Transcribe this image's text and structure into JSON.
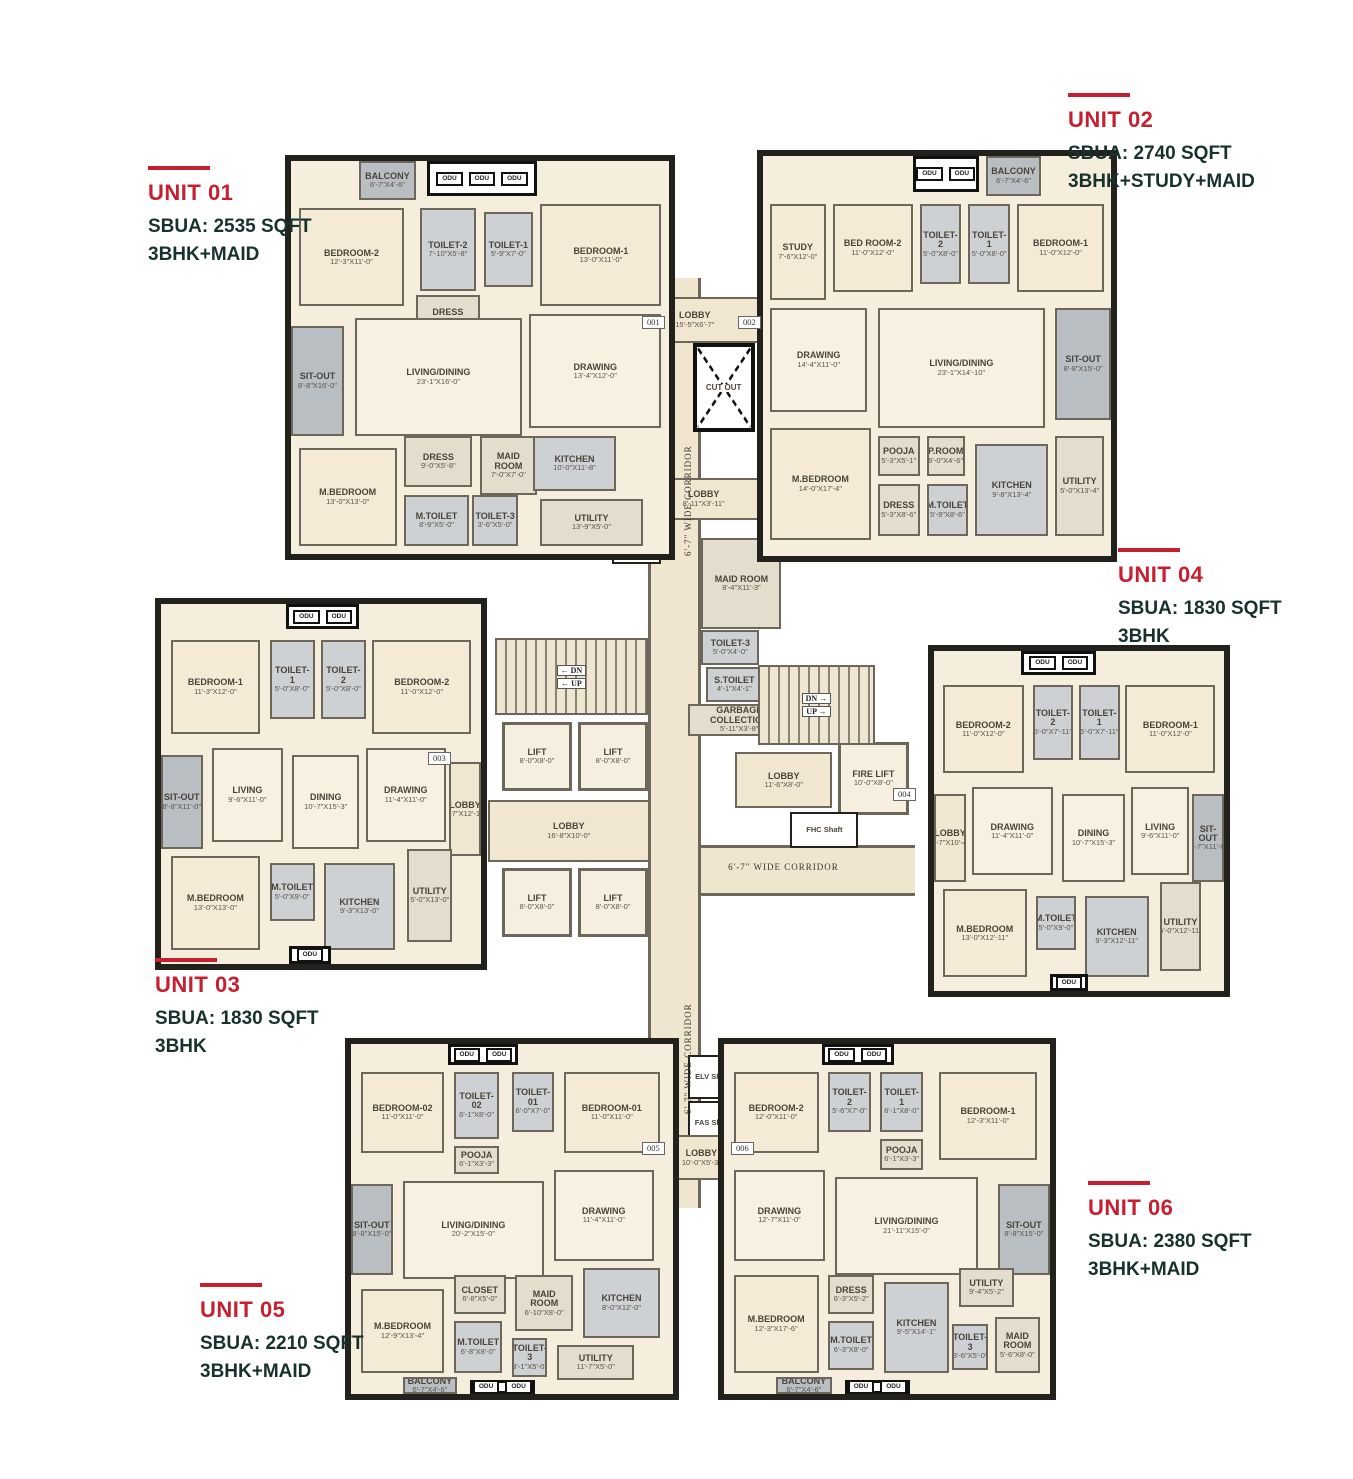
{
  "palette": {
    "accent_red": "#c61f30",
    "text_dark": "#17312c",
    "wall": "#23211c",
    "floor": "#f6eedd",
    "wet": "#cdd1d3",
    "outdoor": "#b9bec3"
  },
  "odu_label": "ODU",
  "units": [
    {
      "id": "unit-01",
      "label": "UNIT 01",
      "sbua": "SBUA: 2535 SQFT",
      "config": "3BHK+MAID",
      "rooms": [
        {
          "name": "BALCONY",
          "dim": "6'-7\"X4'-6\"",
          "kind": "outdoor"
        },
        {
          "name": "BEDROOM-2",
          "dim": "12'-3\"X11'-0\"",
          "kind": "bed"
        },
        {
          "name": "TOILET-2",
          "dim": "7'-10\"X5'-8\"",
          "kind": "wet"
        },
        {
          "name": "TOILET-1",
          "dim": "5'-9\"X7'-0\"",
          "kind": "wet"
        },
        {
          "name": "BEDROOM-1",
          "dim": "13'-0\"X11'-0\"",
          "kind": "bed"
        },
        {
          "name": "DRESS",
          "dim": "8'-0\"X5'-8\"",
          "kind": "service"
        },
        {
          "name": "SIT-OUT",
          "dim": "8'-8\"X16'-0\"",
          "kind": "outdoor"
        },
        {
          "name": "LIVING/DINING",
          "dim": "23'-1\"X16'-0\"",
          "kind": "living"
        },
        {
          "name": "DRAWING",
          "dim": "13'-4\"X12'-0\"",
          "kind": "living"
        },
        {
          "name": "M.BEDROOM",
          "dim": "13'-0\"X13'-0\"",
          "kind": "bed"
        },
        {
          "name": "DRESS",
          "dim": "9'-0\"X5'-8\"",
          "kind": "service"
        },
        {
          "name": "MAID ROOM",
          "dim": "7'-0\"X7'-0\"",
          "kind": "service"
        },
        {
          "name": "M.TOILET",
          "dim": "8'-9\"X5'-0\"",
          "kind": "wet"
        },
        {
          "name": "TOILET-3",
          "dim": "3'-6\"X5'-0\"",
          "kind": "wet"
        },
        {
          "name": "KITCHEN",
          "dim": "10'-0\"X11'-8\"",
          "kind": "wet"
        },
        {
          "name": "UTILITY",
          "dim": "13'-9\"X5'-0\"",
          "kind": "service"
        }
      ]
    },
    {
      "id": "unit-02",
      "label": "UNIT 02",
      "sbua": "SBUA: 2740 SQFT",
      "config": "3BHK+STUDY+MAID",
      "rooms": [
        {
          "name": "BALCONY",
          "dim": "6'-7\"X4'-6\"",
          "kind": "outdoor"
        },
        {
          "name": "STUDY",
          "dim": "7'-6\"X12'-0\"",
          "kind": "bed"
        },
        {
          "name": "BED ROOM-2",
          "dim": "11'-0\"X12'-0\"",
          "kind": "bed"
        },
        {
          "name": "TOILET-2",
          "dim": "5'-0\"X8'-0\"",
          "kind": "wet"
        },
        {
          "name": "TOILET-1",
          "dim": "5'-0\"X8'-0\"",
          "kind": "wet"
        },
        {
          "name": "BEDROOM-1",
          "dim": "11'-0\"X12'-0\"",
          "kind": "bed"
        },
        {
          "name": "DRAWING",
          "dim": "14'-4\"X11'-0\"",
          "kind": "living"
        },
        {
          "name": "LIVING/DINING",
          "dim": "23'-1\"X14'-10\"",
          "kind": "living"
        },
        {
          "name": "SIT-OUT",
          "dim": "8'-8\"X15'-0\"",
          "kind": "outdoor"
        },
        {
          "name": "M.BEDROOM",
          "dim": "14'-0\"X17'-4\"",
          "kind": "bed"
        },
        {
          "name": "POOJA",
          "dim": "5'-3\"X5'-1\"",
          "kind": "service"
        },
        {
          "name": "P.ROOM",
          "dim": "6'-0\"X4'-6\"",
          "kind": "service"
        },
        {
          "name": "DRESS",
          "dim": "5'-3\"X8'-6\"",
          "kind": "service"
        },
        {
          "name": "M.TOILET",
          "dim": "5'-9\"X8'-6\"",
          "kind": "wet"
        },
        {
          "name": "KITCHEN",
          "dim": "9'-8\"X13'-4\"",
          "kind": "wet"
        },
        {
          "name": "UTILITY",
          "dim": "5'-0\"X13'-4\"",
          "kind": "service"
        }
      ]
    },
    {
      "id": "unit-03",
      "label": "UNIT 03",
      "sbua": "SBUA: 1830 SQFT",
      "config": "3BHK",
      "rooms": [
        {
          "name": "BEDROOM-1",
          "dim": "11'-3\"X12'-0\"",
          "kind": "bed"
        },
        {
          "name": "TOILET-1",
          "dim": "5'-0\"X8'-0\"",
          "kind": "wet"
        },
        {
          "name": "TOILET-2",
          "dim": "5'-0\"X8'-0\"",
          "kind": "wet"
        },
        {
          "name": "BEDROOM-2",
          "dim": "11'-0\"X12'-0\"",
          "kind": "bed"
        },
        {
          "name": "SIT-OUT",
          "dim": "8'-8\"X11'-0\"",
          "kind": "outdoor"
        },
        {
          "name": "LIVING",
          "dim": "9'-6\"X11'-0\"",
          "kind": "living"
        },
        {
          "name": "DINING",
          "dim": "10'-7\"X15'-3\"",
          "kind": "living"
        },
        {
          "name": "DRAWING",
          "dim": "11'-4\"X11'-0\"",
          "kind": "living"
        },
        {
          "name": "LOBBY",
          "dim": "6'-7\"X12'-11\"",
          "kind": "lobby"
        },
        {
          "name": "M.BEDROOM",
          "dim": "13'-0\"X13'-0\"",
          "kind": "bed"
        },
        {
          "name": "M.TOILET",
          "dim": "5'-0\"X9'-0\"",
          "kind": "wet"
        },
        {
          "name": "KITCHEN",
          "dim": "9'-3\"X13'-0\"",
          "kind": "wet"
        },
        {
          "name": "UTILITY",
          "dim": "5'-0\"X13'-0\"",
          "kind": "service"
        }
      ]
    },
    {
      "id": "unit-04",
      "label": "UNIT 04",
      "sbua": "SBUA: 1830 SQFT",
      "config": "3BHK",
      "rooms": [
        {
          "name": "BEDROOM-2",
          "dim": "11'-0\"X12'-0\"",
          "kind": "bed"
        },
        {
          "name": "TOILET-2",
          "dim": "5'-0\"X7'-11\"",
          "kind": "wet"
        },
        {
          "name": "TOILET-1",
          "dim": "5'-0\"X7'-11\"",
          "kind": "wet"
        },
        {
          "name": "BEDROOM-1",
          "dim": "11'-0\"X12'-0\"",
          "kind": "bed"
        },
        {
          "name": "LOBBY",
          "dim": "6'-7\"X10'-4\"",
          "kind": "lobby"
        },
        {
          "name": "DRAWING",
          "dim": "11'-4\"X11'-0\"",
          "kind": "living"
        },
        {
          "name": "DINING",
          "dim": "10'-7\"X15'-3\"",
          "kind": "living"
        },
        {
          "name": "LIVING",
          "dim": "9'-6\"X11'-0\"",
          "kind": "living"
        },
        {
          "name": "SIT-OUT",
          "dim": "8'-7\"X11'-0\"",
          "kind": "outdoor"
        },
        {
          "name": "M.BEDROOM",
          "dim": "13'-0\"X12'-11\"",
          "kind": "bed"
        },
        {
          "name": "M.TOILET",
          "dim": "5'-0\"X9'-0\"",
          "kind": "wet"
        },
        {
          "name": "KITCHEN",
          "dim": "9'-3\"X12'-11\"",
          "kind": "wet"
        },
        {
          "name": "UTILITY",
          "dim": "5'-0\"X12'-11\"",
          "kind": "service"
        }
      ]
    },
    {
      "id": "unit-05",
      "label": "UNIT 05",
      "sbua": "SBUA: 2210 SQFT",
      "config": "3BHK+MAID",
      "rooms": [
        {
          "name": "BEDROOM-02",
          "dim": "11'-0\"X11'-0\"",
          "kind": "bed"
        },
        {
          "name": "TOILET-02",
          "dim": "6'-1\"X8'-0\"",
          "kind": "wet"
        },
        {
          "name": "TOILET-01",
          "dim": "6'-0\"X7'-0\"",
          "kind": "wet"
        },
        {
          "name": "BEDROOM-01",
          "dim": "11'-0\"X11'-0\"",
          "kind": "bed"
        },
        {
          "name": "POOJA",
          "dim": "6'-1\"X3'-3\"",
          "kind": "service"
        },
        {
          "name": "SIT-OUT",
          "dim": "8'-8\"X15'-0\"",
          "kind": "outdoor"
        },
        {
          "name": "LIVING/DINING",
          "dim": "20'-2\"X15'-0\"",
          "kind": "living"
        },
        {
          "name": "DRAWING",
          "dim": "11'-4\"X11'-0\"",
          "kind": "living"
        },
        {
          "name": "M.BEDROOM",
          "dim": "12'-9\"X13'-4\"",
          "kind": "bed"
        },
        {
          "name": "CLOSET",
          "dim": "6'-8\"X5'-0\"",
          "kind": "service"
        },
        {
          "name": "MAID ROOM",
          "dim": "6'-10\"X8'-0\"",
          "kind": "service"
        },
        {
          "name": "KITCHEN",
          "dim": "8'-0\"X12'-0\"",
          "kind": "wet"
        },
        {
          "name": "M.TOILET",
          "dim": "6'-8\"X8'-0\"",
          "kind": "wet"
        },
        {
          "name": "TOILET-3",
          "dim": "3'-1\"X5'-0\"",
          "kind": "wet"
        },
        {
          "name": "UTILITY",
          "dim": "11'-7\"X5'-0\"",
          "kind": "service"
        },
        {
          "name": "BALCONY",
          "dim": "6'-7\"X4'-6\"",
          "kind": "outdoor"
        }
      ]
    },
    {
      "id": "unit-06",
      "label": "UNIT 06",
      "sbua": "SBUA: 2380 SQFT",
      "config": "3BHK+MAID",
      "rooms": [
        {
          "name": "BEDROOM-2",
          "dim": "12'-0\"X11'-0\"",
          "kind": "bed"
        },
        {
          "name": "TOILET-2",
          "dim": "5'-6\"X7'-0\"",
          "kind": "wet"
        },
        {
          "name": "TOILET-1",
          "dim": "6'-1\"X8'-0\"",
          "kind": "wet"
        },
        {
          "name": "POOJA",
          "dim": "6'-1\"X3'-3\"",
          "kind": "service"
        },
        {
          "name": "BEDROOM-1",
          "dim": "12'-3\"X11'-0\"",
          "kind": "bed"
        },
        {
          "name": "DRAWING",
          "dim": "12'-7\"X11'-0\"",
          "kind": "living"
        },
        {
          "name": "LIVING/DINING",
          "dim": "21'-11\"X15'-0\"",
          "kind": "living"
        },
        {
          "name": "SIT-OUT",
          "dim": "8'-8\"X15'-0\"",
          "kind": "outdoor"
        },
        {
          "name": "M.BEDROOM",
          "dim": "12'-3\"X17'-6\"",
          "kind": "bed"
        },
        {
          "name": "DRESS",
          "dim": "6'-3\"X5'-2\"",
          "kind": "service"
        },
        {
          "name": "M.TOILET",
          "dim": "6'-3\"X8'-0\"",
          "kind": "wet"
        },
        {
          "name": "KITCHEN",
          "dim": "9'-5\"X14'-1\"",
          "kind": "wet"
        },
        {
          "name": "UTILITY",
          "dim": "9'-4\"X5'-2\"",
          "kind": "service"
        },
        {
          "name": "TOILET-3",
          "dim": "3'-6\"X5'-0\"",
          "kind": "wet"
        },
        {
          "name": "MAID ROOM",
          "dim": "5'-6\"X8'-0\"",
          "kind": "service"
        },
        {
          "name": "BALCONY",
          "dim": "6'-7\"X4'-6\"",
          "kind": "outdoor"
        }
      ]
    }
  ],
  "core": {
    "corridor_label": "6'-7\" WIDE CORRIDOR",
    "cutout_label": "CUT OUT",
    "stairs": {
      "dn": "DN",
      "up": "UP"
    },
    "door_tags": [
      "001",
      "002",
      "003",
      "004",
      "005",
      "006"
    ],
    "rooms": [
      {
        "name": "LOBBY",
        "dim": "15'-5\"X6'-7\"",
        "kind": "lobby"
      },
      {
        "name": "CUT OUT",
        "dim": "",
        "kind": "cutout"
      },
      {
        "name": "LOBBY",
        "dim": "8'-11\"X3'-11\"",
        "kind": "lobby"
      },
      {
        "name": "MAID ROOM",
        "dim": "8'-4\"X11'-3\"",
        "kind": "service"
      },
      {
        "name": "TOILET-3",
        "dim": "5'-0\"X4'-0\"",
        "kind": "wet"
      },
      {
        "name": "S.TOILET",
        "dim": "4'-1\"X4'-1\"",
        "kind": "wet"
      },
      {
        "name": "GARBAGE COLLECTION",
        "dim": "5'-11\"X3'-8\"",
        "kind": "service"
      },
      {
        "name": "FHC Shaft",
        "dim": "",
        "kind": "shaft"
      },
      {
        "name": "LIFT",
        "dim": "8'-0\"X8'-0\"",
        "kind": "lift"
      },
      {
        "name": "LIFT",
        "dim": "8'-0\"X8'-0\"",
        "kind": "lift"
      },
      {
        "name": "LOBBY",
        "dim": "16'-8\"X10'-0\"",
        "kind": "lobby"
      },
      {
        "name": "LIFT",
        "dim": "8'-0\"X8'-0\"",
        "kind": "lift"
      },
      {
        "name": "LIFT",
        "dim": "8'-0\"X8'-0\"",
        "kind": "lift"
      },
      {
        "name": "LOBBY",
        "dim": "11'-6\"X8'-0\"",
        "kind": "lobby"
      },
      {
        "name": "FIRE LIFT",
        "dim": "10'-0\"X8'-0\"",
        "kind": "lift"
      },
      {
        "name": "FHC Shaft",
        "dim": "",
        "kind": "shaft"
      },
      {
        "name": "ELV Shaft",
        "dim": "",
        "kind": "shaft"
      },
      {
        "name": "FAS Shaft",
        "dim": "",
        "kind": "shaft"
      },
      {
        "name": "LOBBY",
        "dim": "10'-0\"X5'-3\"",
        "kind": "lobby"
      }
    ]
  }
}
